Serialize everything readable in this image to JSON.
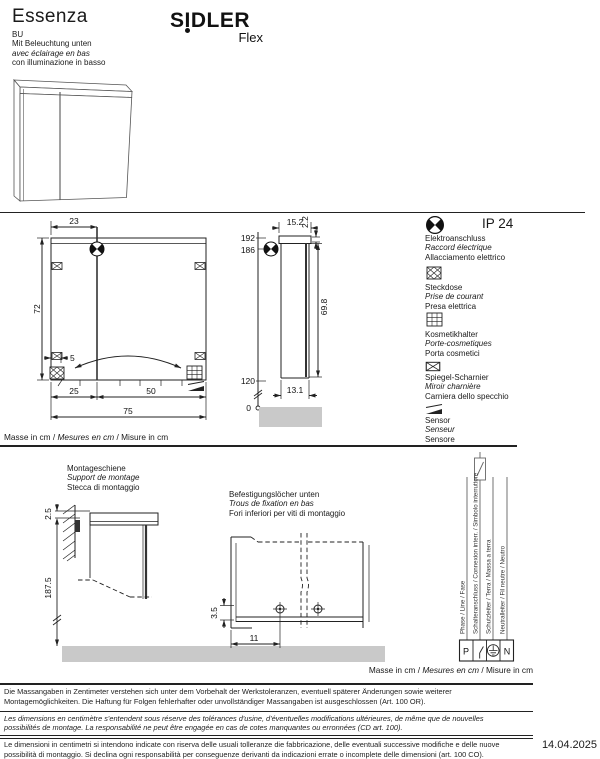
{
  "header": {
    "title": "Essenza",
    "brand": "SIDLER",
    "brand_sub": "Flex",
    "code": "BU",
    "desc_de": "Mit Beleuchtung unten",
    "desc_fr": "avec éclairage en bas",
    "desc_it": "con illuminazione in basso"
  },
  "front_view": {
    "door_width": "23",
    "height": "72",
    "socket_offset": "5",
    "left": "25",
    "right": "50",
    "total": "75"
  },
  "side_view": {
    "depth": "15.2",
    "light": "2.2",
    "h_top": "192",
    "h_sensor": "186",
    "door": "69.8",
    "h_bottom": "120",
    "depth_body": "13.1",
    "zero": "0"
  },
  "legend": {
    "ip_rating": "IP 24",
    "items": [
      {
        "de": "Elektroanschluss",
        "fr": "Raccord électrique",
        "it": "Allacciamento elettrico"
      },
      {
        "de": "Steckdose",
        "fr": "Prise de courant",
        "it": "Presa elettrica"
      },
      {
        "de": "Kosmetikhalter",
        "fr": "Porte-cosmetiques",
        "it": "Porta cosmetici"
      },
      {
        "de": "Spiegel-Scharnier",
        "fr": "Miroir charnière",
        "it": "Carniera dello specchio"
      },
      {
        "de": "Sensor",
        "fr": "Senseur",
        "it": "Sensore"
      }
    ]
  },
  "units": {
    "de": "Masse in cm",
    "fr": "Mesures en cm",
    "it": "Misure in cm",
    "sep": " / "
  },
  "rail": {
    "title_de": "Montageschiene",
    "title_fr": "Support de montage",
    "title_it": "Stecca di montaggio",
    "offset": "2.5",
    "height": "187.5"
  },
  "holes": {
    "title_de": "Befestigungslöcher unten",
    "title_fr": "Trous de fixation en bas",
    "title_it": "Fori inferiori per viti di montaggio",
    "spacing": "11",
    "offset": "3.5"
  },
  "wiring": {
    "labels": [
      "Phase / Line / Fase",
      "Schalteranschluss / Connexion interr. / Simbolo interruttore",
      "Schutzleiter / Terra / Massa a terra",
      "Neutralleiter / Fil neutre / Neutro"
    ],
    "p": "P",
    "n": "N"
  },
  "footer": {
    "de": "Die Massangaben in Zentimeter verstehen sich unter dem Vorbehalt der Werkstoleranzen, eventuell späterer Änderungen sowie weiterer Montagemöglichkeiten. Die Haftung für Folgen fehlerhafter oder unvollständiger Massangaben ist ausgeschlossen (Art. 100 OR).",
    "fr": "Les dimensions en centimètre s'entendent sous réserve des tolérances d'usine, d'éventuelles modifications ultérieures, de même que de nouvelles possibilités de montage. La responsabilité ne peut être engagée en cas de cotes manquantes ou erronnées (CD art. 100).",
    "it": "Le dimensioni in centimetri si intendono indicate con riserva delle usuali tolleranze die fabbricazione, delle eventuali successive modifiche e delle nuove possibilità di montaggio. Si declina ogni responsabilità per conseguenze derivanti da indicazioni errate o incomplete delle dimensioni (art. 100 CO).",
    "date": "14.04.2025"
  },
  "colors": {
    "ink": "#1a1a1a",
    "floor_gray": "#c9c9c9",
    "wire_gray": "#8a8a8a"
  }
}
